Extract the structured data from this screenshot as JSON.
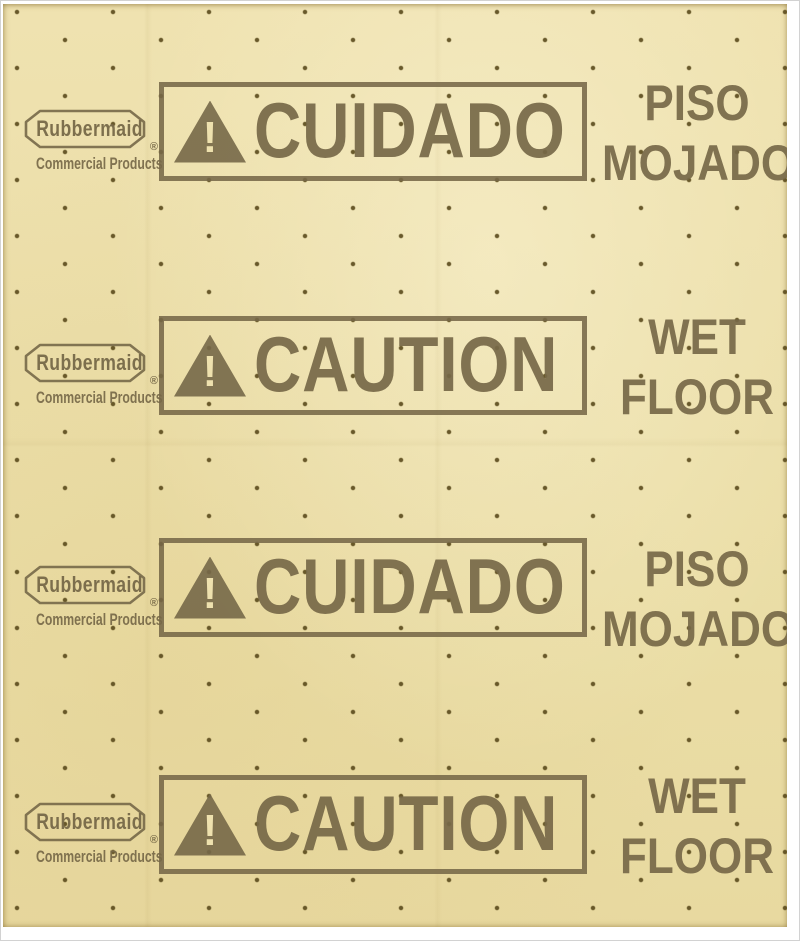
{
  "product": {
    "description": "Yellow over-the-spill caution pad with printed bilingual wet floor warnings and perforation dots",
    "brand": "Rubbermaid",
    "brand_registered": "®",
    "brand_subtitle": "Commercial Products",
    "warning_exclamation": "!",
    "rows": [
      {
        "banner": "CUIDADO",
        "side_line1": "PISO",
        "side_line2": "MOJADO"
      },
      {
        "banner": "CAUTION",
        "side_line1": "WET",
        "side_line2": "FLOOR"
      },
      {
        "banner": "CUIDADO",
        "side_line1": "PISO",
        "side_line2": "MOJADO"
      },
      {
        "banner": "CAUTION",
        "side_line1": "WET",
        "side_line2": "FLOOR"
      }
    ],
    "colors": {
      "background": "#ffffff",
      "pad": "#ecdfaa",
      "print": "#766848",
      "dot": "#5a4a1c"
    }
  }
}
